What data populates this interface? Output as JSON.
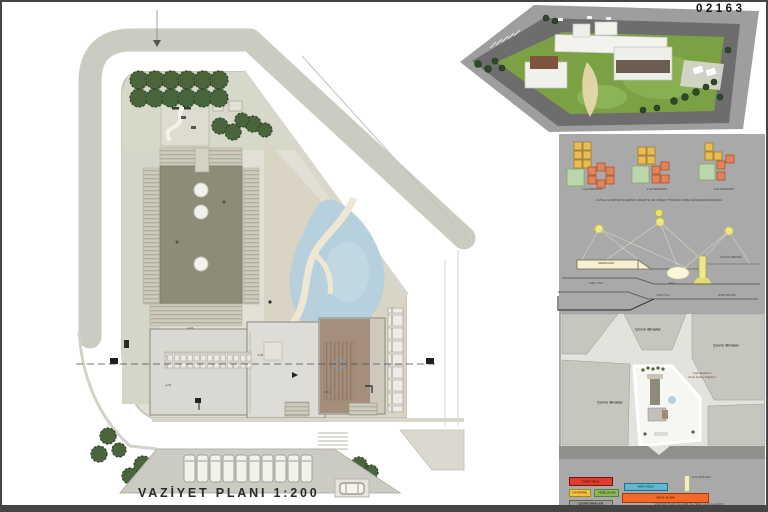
{
  "header": {
    "entry_number": "02163"
  },
  "plan": {
    "title": "VAZİYET PLANI 1:200",
    "spot_levels": [
      "+0.00",
      "-0.45",
      "+1.50",
      "-1.35"
    ]
  },
  "massing": {
    "alternatives": [
      {
        "label": "1.ALTERNATİF"
      },
      {
        "label": "2.ALTERNATİF"
      },
      {
        "label": "3.ALTERNATİF"
      }
    ],
    "caption": "KÜTLE ALTERNATİFLERİNİN ARAZİYE VE GÜNEŞ YÖNÜNE GÖRE DEĞERLENDİRİLMESİ"
  },
  "section_study": {
    "labels": {
      "classrooms": "DERSLİKLER",
      "culture": "KÜLTÜR MERKEZİ",
      "courtyard": "AVLU",
      "vehicle_road": "TAŞIT YOLU",
      "pedestrian": "YAYA YOLU",
      "gym": "SPOR SALONU"
    }
  },
  "context": {
    "surrounding_top": "Çevre Binalar",
    "surrounding_right": "Çevre Binalar",
    "surrounding_left": "Çevre Binalar",
    "green_note": "Yeşil Alanların\nArazi İçinde Dağılımı"
  },
  "legend": {
    "items": [
      {
        "label": "TAŞIT YOLU",
        "color": "#e23b2e"
      },
      {
        "label": "OTOPARK",
        "color": "#ecc83f"
      },
      {
        "label": "YEŞİL ALAN",
        "color": "#8cb85c"
      },
      {
        "label": "ÇEVRE BİNALAR",
        "color": "#9d9d95"
      },
      {
        "label": "YAYA YOLU",
        "color": "#5fb9d6"
      },
      {
        "label": "OKUL ALANI",
        "color": "#f26a28"
      },
      {
        "label": "ANA GİRİŞ AKSI",
        "color": "#f3edc2"
      }
    ],
    "caption": "VAZİYET PLANI ULAŞIM VE YEŞİL ALAN LEJANTI"
  }
}
